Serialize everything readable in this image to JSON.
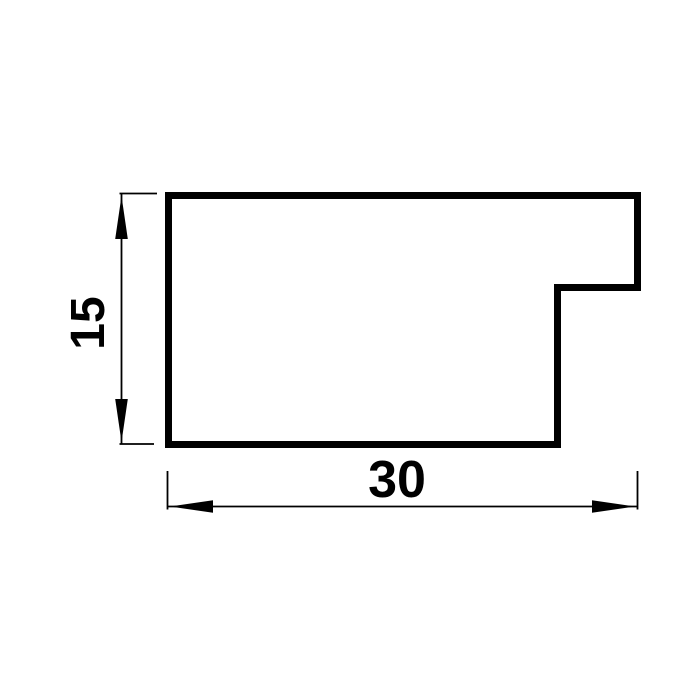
{
  "diagram": {
    "kind": "technical-drawing-cross-section",
    "background_color": "#ffffff",
    "line_color": "#000000",
    "profile": {
      "outline_points_px": [
        [
          168.5,
          195.5
        ],
        [
          637.5,
          195.5
        ],
        [
          637.5,
          287.5
        ],
        [
          557.5,
          287.5
        ],
        [
          557.5,
          444.5
        ],
        [
          168.5,
          444.5
        ]
      ],
      "stroke_width_px": 7
    },
    "dimensions": {
      "height": {
        "label": "15",
        "orientation": "vertical"
      },
      "width": {
        "label": "30",
        "orientation": "horizontal"
      }
    }
  }
}
